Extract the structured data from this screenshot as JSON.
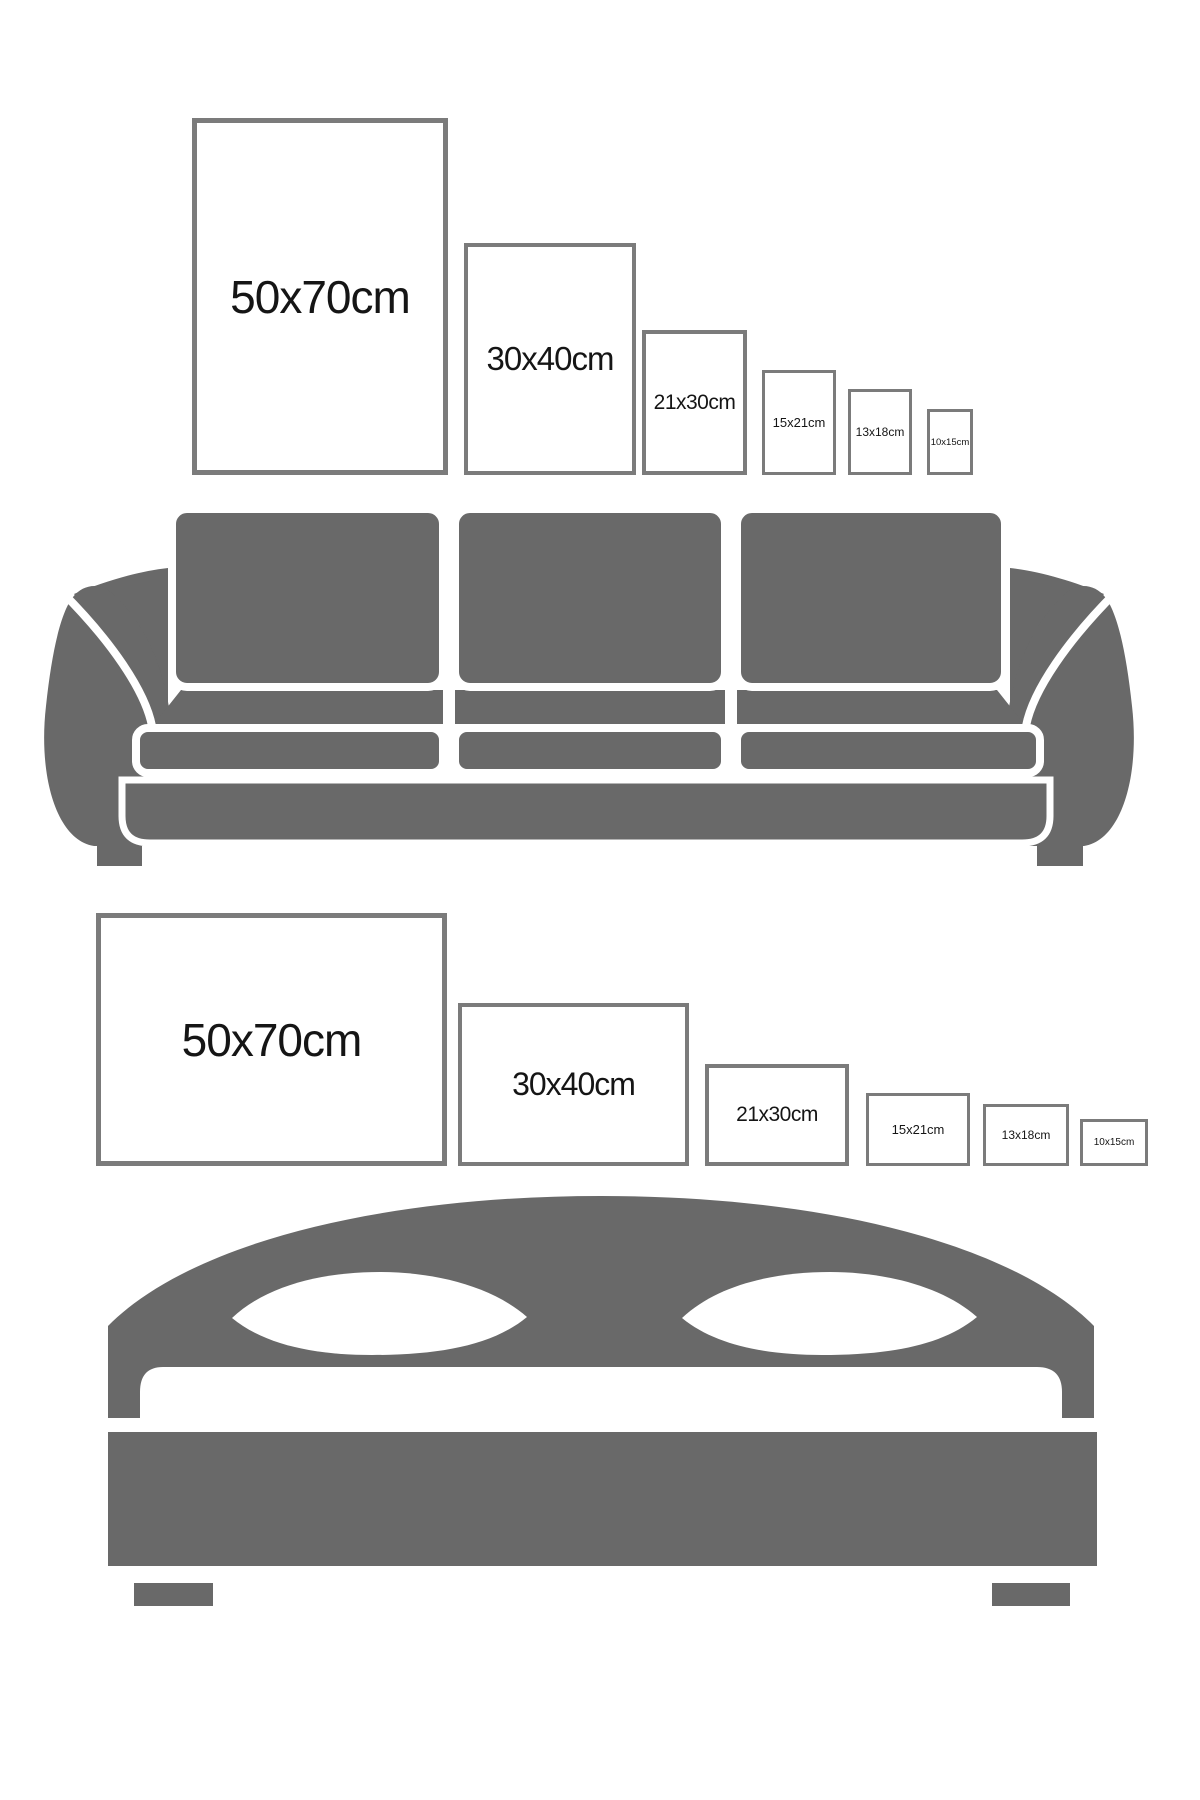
{
  "title": "Poster size comparison with sofa and bed",
  "colors": {
    "furniture_gray": "#696969",
    "frame_border": "#7b7b7b",
    "label_text": "#151515",
    "background": "#ffffff"
  },
  "sofa_section": {
    "furniture": "sofa",
    "orientation": "portrait",
    "frames": [
      {
        "label": "50x70cm"
      },
      {
        "label": "30x40cm"
      },
      {
        "label": "21x30cm"
      },
      {
        "label": "15x21cm"
      },
      {
        "label": "13x18cm"
      },
      {
        "label": "10x15cm"
      }
    ]
  },
  "bed_section": {
    "furniture": "bed",
    "orientation": "landscape",
    "frames": [
      {
        "label": "50x70cm"
      },
      {
        "label": "30x40cm"
      },
      {
        "label": "21x30cm"
      },
      {
        "label": "15x21cm"
      },
      {
        "label": "13x18cm"
      },
      {
        "label": "10x15cm"
      }
    ]
  }
}
